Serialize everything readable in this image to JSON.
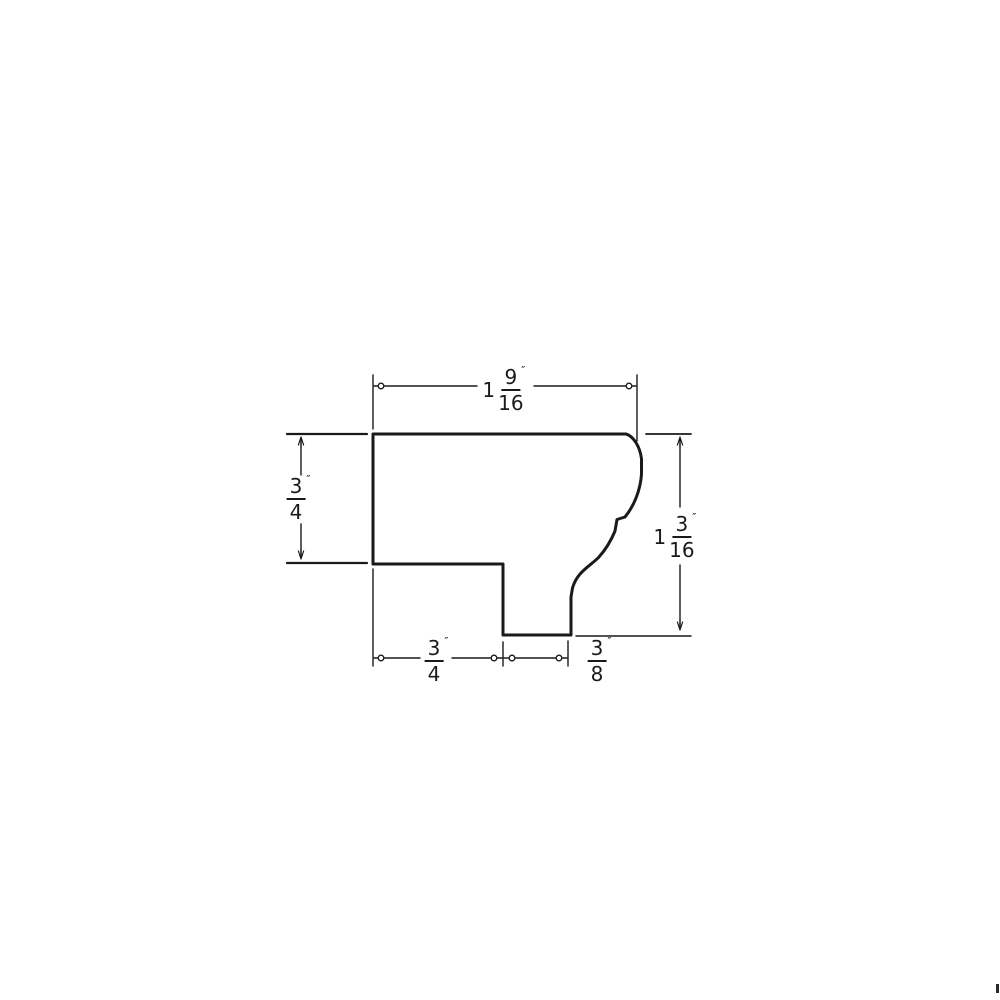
{
  "drawing": {
    "type": "molding-profile-cross-section",
    "colors": {
      "line": "#1a1a1a",
      "background": "#ffffff"
    },
    "dimensions": {
      "top_width": {
        "display": "1 9/16\"",
        "whole": "1",
        "numerator": "9",
        "denominator": "16",
        "unit": "″"
      },
      "left_height": {
        "display": "3/4\"",
        "whole": "",
        "numerator": "3",
        "denominator": "4",
        "unit": "″"
      },
      "right_height": {
        "display": "1 3/16\"",
        "whole": "1",
        "numerator": "3",
        "denominator": "16",
        "unit": "″"
      },
      "bottom_left_width": {
        "display": "3/4\"",
        "whole": "",
        "numerator": "3",
        "denominator": "4",
        "unit": "″"
      },
      "bottom_right_width": {
        "display": "3/8\"",
        "whole": "",
        "numerator": "3",
        "denominator": "8",
        "unit": "″"
      }
    }
  }
}
